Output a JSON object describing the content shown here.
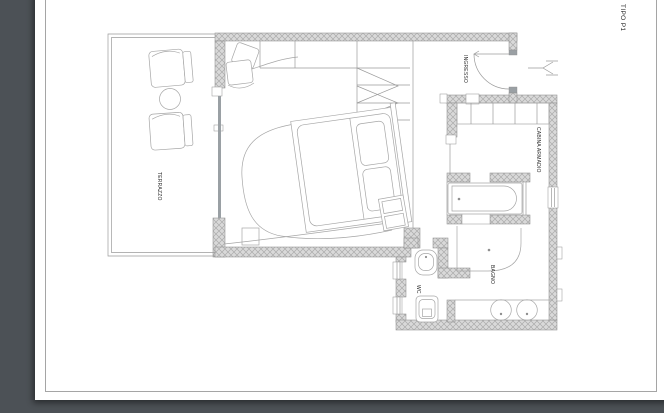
{
  "drawing": {
    "title": "TIPO P1",
    "rooms": {
      "terrazzo": "TERRAZZO",
      "ingresso": "INGRESSO",
      "cabina_armadio": "CABINA ARMADIO",
      "bagno": "BAGNO",
      "wc": "WC"
    },
    "colors": {
      "canvas_background": "#4c5156",
      "paper": "#ffffff",
      "plan_line": "#9b9b9b",
      "wall_fill": "#d9d9d9",
      "wall_hatch": "#ababab",
      "label_text": "#2d2d2d"
    }
  }
}
